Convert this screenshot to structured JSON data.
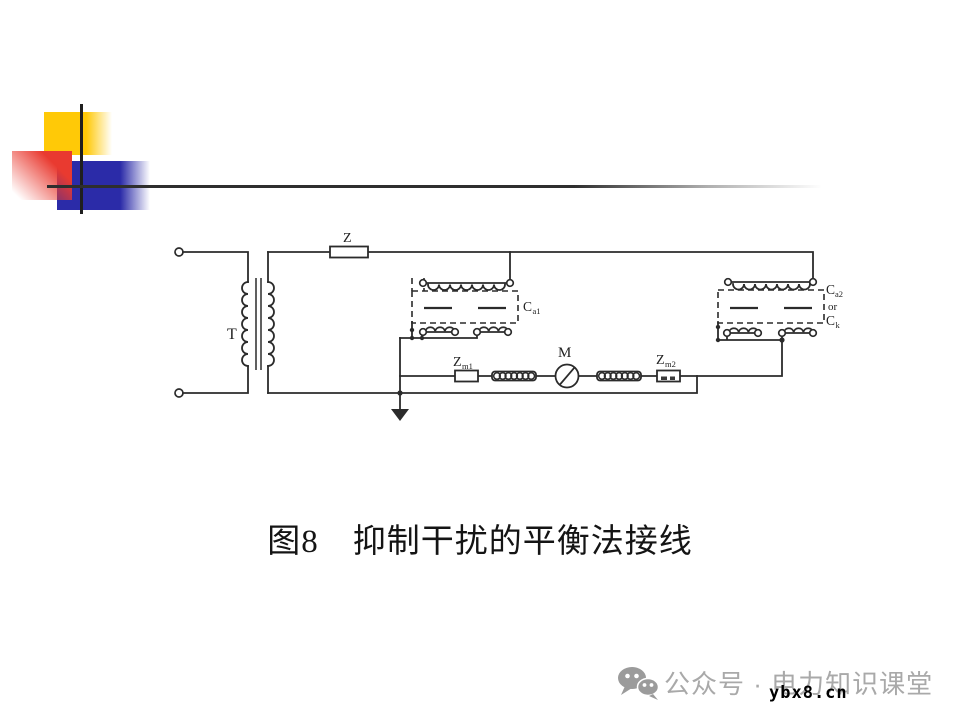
{
  "slide": {
    "caption": "图8　抑制干扰的平衡法接线"
  },
  "diagram": {
    "labels": {
      "transformer": "T",
      "impedance": "Z",
      "meter": "M",
      "zm1": {
        "main": "Z",
        "sub": "m1"
      },
      "zm2": {
        "main": "Z",
        "sub": "m2"
      },
      "cap1": {
        "main": "C",
        "sub": "a1"
      },
      "cap2": {
        "main": "C",
        "sub": "a2",
        "or": "or",
        "alt_main": "C",
        "alt_sub": "k"
      }
    }
  },
  "watermark": {
    "icon": "wechat-icon",
    "text": "公众号 · 电力知识课堂",
    "url": "ybx8.cn"
  },
  "colors": {
    "accent_yellow": "#FFC907",
    "accent_red": "#E93A30",
    "accent_blue": "#2B2BA8",
    "line_dark": "#2B2B2B",
    "watermark_gray": "#A9A9A9"
  }
}
